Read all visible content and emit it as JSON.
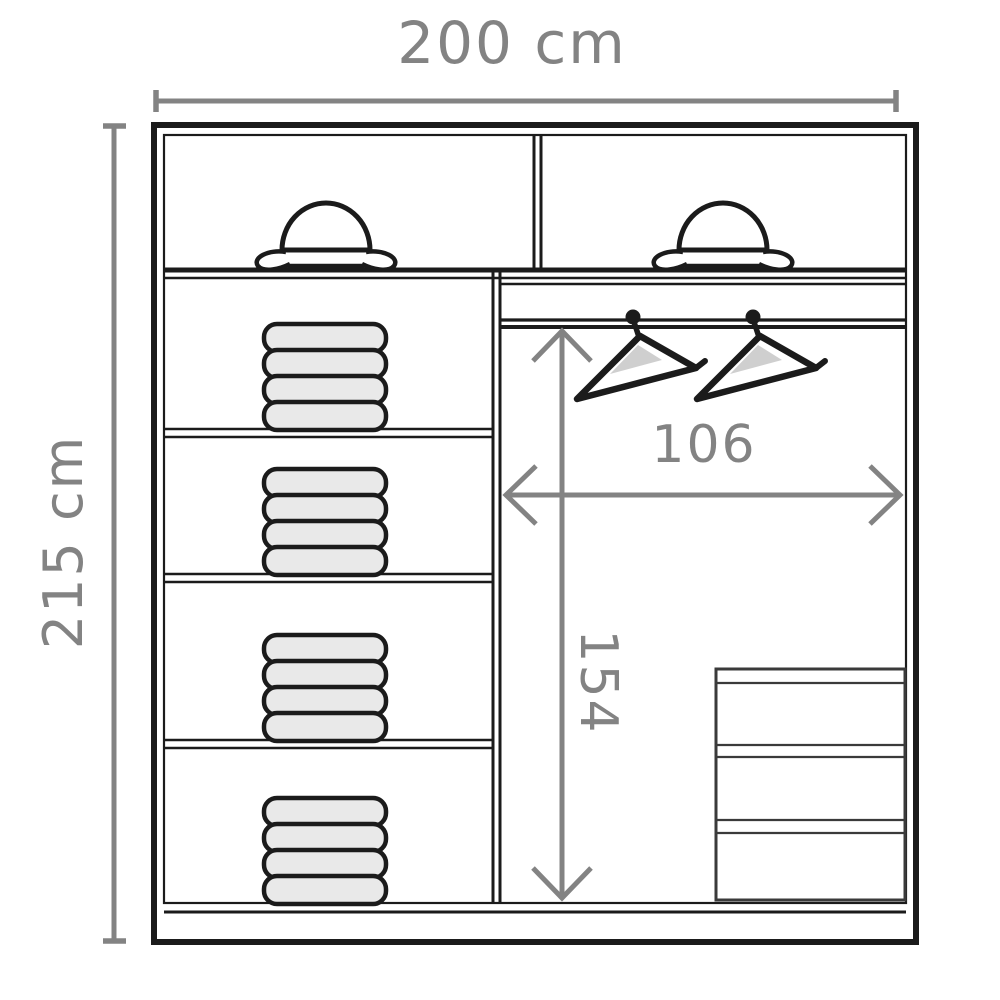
{
  "page": {
    "title": "Wardrobe interior dimensions diagram"
  },
  "dimensions": {
    "overall_width": {
      "label": "200 cm"
    },
    "overall_height": {
      "label": "215 cm"
    },
    "interior_width": {
      "label": "106"
    },
    "interior_height": {
      "label": "154"
    }
  },
  "wardrobe": {
    "top_row": {
      "hat_compartments": 2,
      "hat_icons": 2
    },
    "left_column": {
      "shelves": 3,
      "clothes_stacks": 4,
      "folded_items_per_stack": 4
    },
    "right_section": {
      "hanging_rail": 1,
      "hanger_icons": 2,
      "drawers": 3
    }
  },
  "colors": {
    "dim-color": "#838383",
    "line-color": "#1b1b1b",
    "fill-light": "#e9e9e9",
    "bg": "#ffffff"
  }
}
